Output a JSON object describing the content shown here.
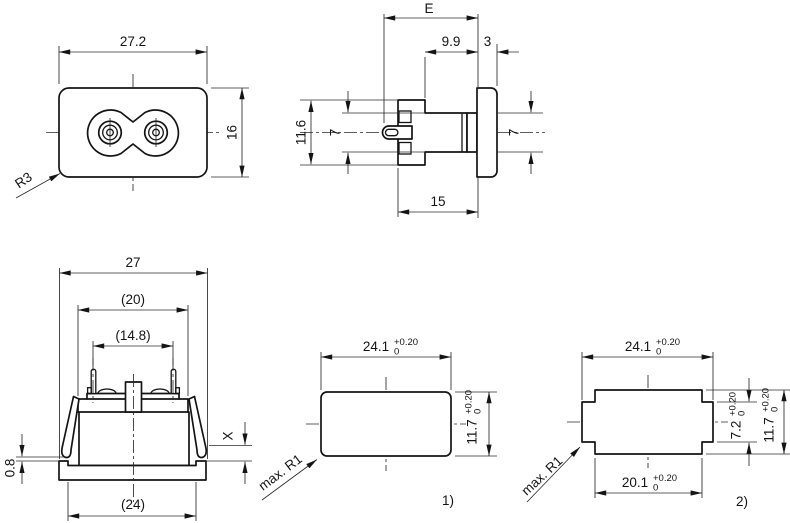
{
  "front": {
    "width": "27.2",
    "height": "16",
    "radius": "R3"
  },
  "side": {
    "e": "E",
    "depth": "9.9",
    "flange": "3",
    "height": "11.6",
    "left7": "7",
    "right7": "7",
    "depth15": "15"
  },
  "rear": {
    "w27": "27",
    "w20": "(20)",
    "w148": "(14.8)",
    "g08": "0.8",
    "px": "X",
    "w24": "(24)"
  },
  "cut1": {
    "w": "24.1",
    "h": "11.7",
    "tp": "+0.20",
    "tz": "0",
    "r": "max. R1",
    "label": "1)"
  },
  "cut2": {
    "w": "24.1",
    "wi": "20.1",
    "hm": "7.2",
    "h": "11.7",
    "tp": "+0.20",
    "tz": "0",
    "r": "max. R1",
    "label": "2)"
  }
}
